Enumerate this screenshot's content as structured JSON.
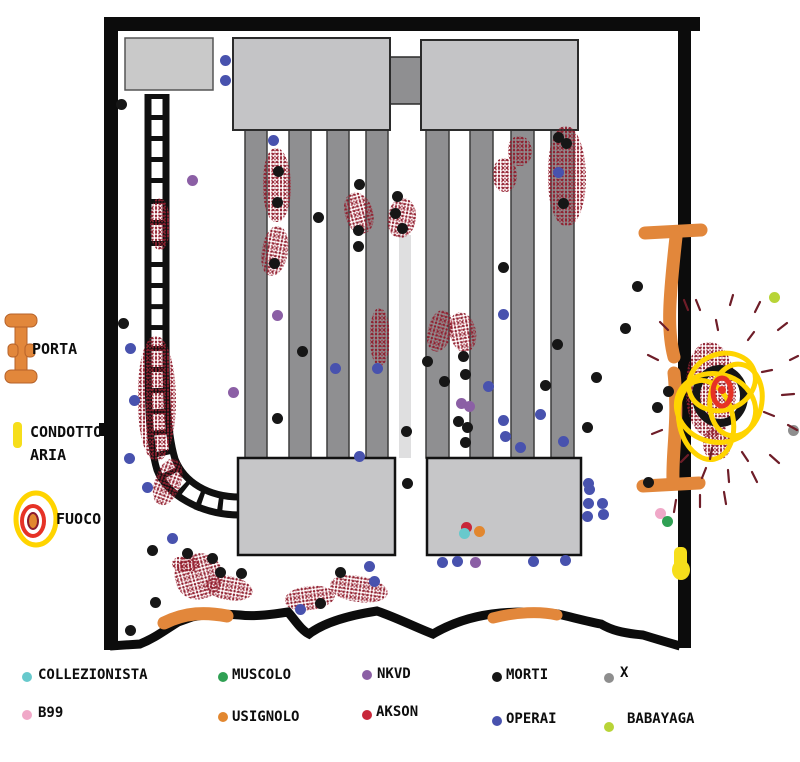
{
  "canvas": {
    "width": 800,
    "height": 762,
    "background": "#ffffff"
  },
  "map": {
    "labels": {
      "porta": "PORTA",
      "condotto_line1": "CONDOTTO",
      "condotto_line2": "ARIA",
      "fuoco": "FUOCO"
    },
    "colors": {
      "wall": "#0c0c0c",
      "machine": "#c4c4c6",
      "pillar": "#8f8f91",
      "door_orange": "#e2873b",
      "duct_yellow": "#f6de1b",
      "blood": "#8b1c2c",
      "fire_yellow": "#ffd400",
      "fire_red": "#e63226"
    },
    "markers": [
      {
        "t": "operai",
        "x": 225,
        "y": 60
      },
      {
        "t": "operai",
        "x": 225,
        "y": 80
      },
      {
        "t": "operai",
        "x": 273,
        "y": 140
      },
      {
        "t": "operai",
        "x": 558,
        "y": 172
      },
      {
        "t": "operai",
        "x": 503,
        "y": 314
      },
      {
        "t": "operai",
        "x": 130,
        "y": 348
      },
      {
        "t": "operai",
        "x": 335,
        "y": 368
      },
      {
        "t": "operai",
        "x": 377,
        "y": 368
      },
      {
        "t": "operai",
        "x": 488,
        "y": 386
      },
      {
        "t": "operai",
        "x": 134,
        "y": 400
      },
      {
        "t": "operai",
        "x": 540,
        "y": 414
      },
      {
        "t": "operai",
        "x": 503,
        "y": 420
      },
      {
        "t": "operai",
        "x": 505,
        "y": 436
      },
      {
        "t": "operai",
        "x": 520,
        "y": 447
      },
      {
        "t": "operai",
        "x": 563,
        "y": 441
      },
      {
        "t": "operai",
        "x": 359,
        "y": 456
      },
      {
        "t": "operai",
        "x": 129,
        "y": 458
      },
      {
        "t": "operai",
        "x": 147,
        "y": 487
      },
      {
        "t": "operai",
        "x": 588,
        "y": 483
      },
      {
        "t": "operai",
        "x": 589,
        "y": 489
      },
      {
        "t": "operai",
        "x": 588,
        "y": 503
      },
      {
        "t": "operai",
        "x": 602,
        "y": 503
      },
      {
        "t": "operai",
        "x": 587,
        "y": 516
      },
      {
        "t": "operai",
        "x": 603,
        "y": 514
      },
      {
        "t": "operai",
        "x": 172,
        "y": 538
      },
      {
        "t": "operai",
        "x": 442,
        "y": 562
      },
      {
        "t": "operai",
        "x": 457,
        "y": 561
      },
      {
        "t": "operai",
        "x": 533,
        "y": 561
      },
      {
        "t": "operai",
        "x": 565,
        "y": 560
      },
      {
        "t": "operai",
        "x": 369,
        "y": 566
      },
      {
        "t": "operai",
        "x": 374,
        "y": 581
      },
      {
        "t": "operai",
        "x": 300,
        "y": 609
      },
      {
        "t": "morti",
        "x": 121,
        "y": 104
      },
      {
        "t": "morti",
        "x": 558,
        "y": 137
      },
      {
        "t": "morti",
        "x": 566,
        "y": 143
      },
      {
        "t": "morti",
        "x": 359,
        "y": 184
      },
      {
        "t": "morti",
        "x": 397,
        "y": 196
      },
      {
        "t": "morti",
        "x": 563,
        "y": 203
      },
      {
        "t": "morti",
        "x": 278,
        "y": 171
      },
      {
        "t": "morti",
        "x": 277,
        "y": 202
      },
      {
        "t": "morti",
        "x": 318,
        "y": 217
      },
      {
        "t": "morti",
        "x": 395,
        "y": 213
      },
      {
        "t": "morti",
        "x": 402,
        "y": 228
      },
      {
        "t": "morti",
        "x": 358,
        "y": 230
      },
      {
        "t": "morti",
        "x": 358,
        "y": 246
      },
      {
        "t": "morti",
        "x": 274,
        "y": 263
      },
      {
        "t": "morti",
        "x": 503,
        "y": 267
      },
      {
        "t": "morti",
        "x": 302,
        "y": 351
      },
      {
        "t": "morti",
        "x": 427,
        "y": 361
      },
      {
        "t": "morti",
        "x": 463,
        "y": 356
      },
      {
        "t": "morti",
        "x": 465,
        "y": 374
      },
      {
        "t": "morti",
        "x": 444,
        "y": 381
      },
      {
        "t": "morti",
        "x": 545,
        "y": 385
      },
      {
        "t": "morti",
        "x": 557,
        "y": 344
      },
      {
        "t": "morti",
        "x": 596,
        "y": 377
      },
      {
        "t": "morti",
        "x": 637,
        "y": 286
      },
      {
        "t": "morti",
        "x": 625,
        "y": 328
      },
      {
        "t": "morti",
        "x": 277,
        "y": 418
      },
      {
        "t": "morti",
        "x": 458,
        "y": 421
      },
      {
        "t": "morti",
        "x": 467,
        "y": 427
      },
      {
        "t": "morti",
        "x": 465,
        "y": 442
      },
      {
        "t": "morti",
        "x": 406,
        "y": 431
      },
      {
        "t": "morti",
        "x": 587,
        "y": 427
      },
      {
        "t": "morti",
        "x": 668,
        "y": 391
      },
      {
        "t": "morti",
        "x": 657,
        "y": 407
      },
      {
        "t": "morti",
        "x": 123,
        "y": 323
      },
      {
        "t": "morti",
        "x": 648,
        "y": 482
      },
      {
        "t": "morti",
        "x": 407,
        "y": 483
      },
      {
        "t": "morti",
        "x": 152,
        "y": 550
      },
      {
        "t": "morti",
        "x": 187,
        "y": 553
      },
      {
        "t": "morti",
        "x": 212,
        "y": 558
      },
      {
        "t": "morti",
        "x": 220,
        "y": 572
      },
      {
        "t": "morti",
        "x": 241,
        "y": 573
      },
      {
        "t": "morti",
        "x": 340,
        "y": 572
      },
      {
        "t": "morti",
        "x": 155,
        "y": 602
      },
      {
        "t": "morti",
        "x": 320,
        "y": 603
      },
      {
        "t": "morti",
        "x": 130,
        "y": 630
      },
      {
        "t": "nkvd",
        "x": 192,
        "y": 180
      },
      {
        "t": "nkvd",
        "x": 277,
        "y": 315
      },
      {
        "t": "nkvd",
        "x": 233,
        "y": 392
      },
      {
        "t": "nkvd",
        "x": 461,
        "y": 403
      },
      {
        "t": "nkvd",
        "x": 469,
        "y": 406
      },
      {
        "t": "nkvd",
        "x": 475,
        "y": 562
      },
      {
        "t": "b99",
        "x": 660,
        "y": 513
      },
      {
        "t": "muscolo",
        "x": 667,
        "y": 521
      },
      {
        "t": "akson",
        "x": 466,
        "y": 527
      },
      {
        "t": "collezionista",
        "x": 464,
        "y": 533
      },
      {
        "t": "usignolo",
        "x": 479,
        "y": 531
      },
      {
        "t": "x",
        "x": 793,
        "y": 430
      },
      {
        "t": "babayaga",
        "x": 774,
        "y": 297
      }
    ],
    "blood_patches": [
      {
        "x": 263,
        "y": 148,
        "w": 28,
        "h": 74,
        "r": 0
      },
      {
        "x": 262,
        "y": 226,
        "w": 26,
        "h": 50,
        "r": 10
      },
      {
        "x": 150,
        "y": 198,
        "w": 20,
        "h": 52,
        "r": 0
      },
      {
        "x": 345,
        "y": 192,
        "w": 28,
        "h": 42,
        "r": -15
      },
      {
        "x": 388,
        "y": 198,
        "w": 28,
        "h": 40,
        "r": 10
      },
      {
        "x": 493,
        "y": 158,
        "w": 24,
        "h": 34,
        "r": 0
      },
      {
        "x": 508,
        "y": 136,
        "w": 24,
        "h": 30,
        "r": 0
      },
      {
        "x": 548,
        "y": 126,
        "w": 38,
        "h": 100,
        "r": 0
      },
      {
        "x": 370,
        "y": 308,
        "w": 20,
        "h": 58,
        "r": 0
      },
      {
        "x": 428,
        "y": 310,
        "w": 24,
        "h": 42,
        "r": 15
      },
      {
        "x": 450,
        "y": 312,
        "w": 26,
        "h": 40,
        "r": -10
      },
      {
        "x": 138,
        "y": 336,
        "w": 38,
        "h": 125,
        "r": 0
      },
      {
        "x": 155,
        "y": 458,
        "w": 26,
        "h": 48,
        "r": 20
      },
      {
        "x": 172,
        "y": 556,
        "w": 28,
        "h": 16,
        "r": 0
      },
      {
        "x": 175,
        "y": 553,
        "w": 48,
        "h": 46,
        "r": -15
      },
      {
        "x": 205,
        "y": 576,
        "w": 48,
        "h": 24,
        "r": 10
      },
      {
        "x": 285,
        "y": 586,
        "w": 50,
        "h": 24,
        "r": -8
      },
      {
        "x": 330,
        "y": 576,
        "w": 58,
        "h": 26,
        "r": 8
      },
      {
        "x": 686,
        "y": 342,
        "w": 50,
        "h": 95,
        "r": 0
      },
      {
        "x": 703,
        "y": 428,
        "w": 28,
        "h": 32,
        "r": 0
      }
    ]
  },
  "legend": {
    "items": [
      {
        "id": "collezionista",
        "label": "COLLEZIONISTA",
        "color": "#67c9cc",
        "dx": 22,
        "dy": 672,
        "lx": 38,
        "ly": 667
      },
      {
        "id": "muscolo",
        "label": "MUSCOLO",
        "color": "#2fa053",
        "dx": 218,
        "dy": 672,
        "lx": 232,
        "ly": 667
      },
      {
        "id": "nkvd",
        "label": "NKVD",
        "color": "#8b5fa5",
        "dx": 362,
        "dy": 670,
        "lx": 377,
        "ly": 666
      },
      {
        "id": "morti",
        "label": "MORTI",
        "color": "#161616",
        "dx": 492,
        "dy": 672,
        "lx": 506,
        "ly": 667
      },
      {
        "id": "x",
        "label": "X",
        "color": "#8e8e8e",
        "dx": 604,
        "dy": 673,
        "lx": 620,
        "ly": 665
      },
      {
        "id": "b99",
        "label": "B99",
        "color": "#f0a8c8",
        "dx": 22,
        "dy": 710,
        "lx": 38,
        "ly": 705
      },
      {
        "id": "usignolo",
        "label": "USIGNOLO",
        "color": "#e2872f",
        "dx": 218,
        "dy": 712,
        "lx": 232,
        "ly": 709
      },
      {
        "id": "akson",
        "label": "AKSON",
        "color": "#c8273a",
        "dx": 362,
        "dy": 710,
        "lx": 376,
        "ly": 704
      },
      {
        "id": "operai",
        "label": "OPERAI",
        "color": "#4852ae",
        "dx": 492,
        "dy": 716,
        "lx": 506,
        "ly": 711
      },
      {
        "id": "babayaga",
        "label": "BABAYAGA",
        "color": "#b8d437",
        "dx": 604,
        "dy": 722,
        "lx": 627,
        "ly": 711
      }
    ]
  }
}
